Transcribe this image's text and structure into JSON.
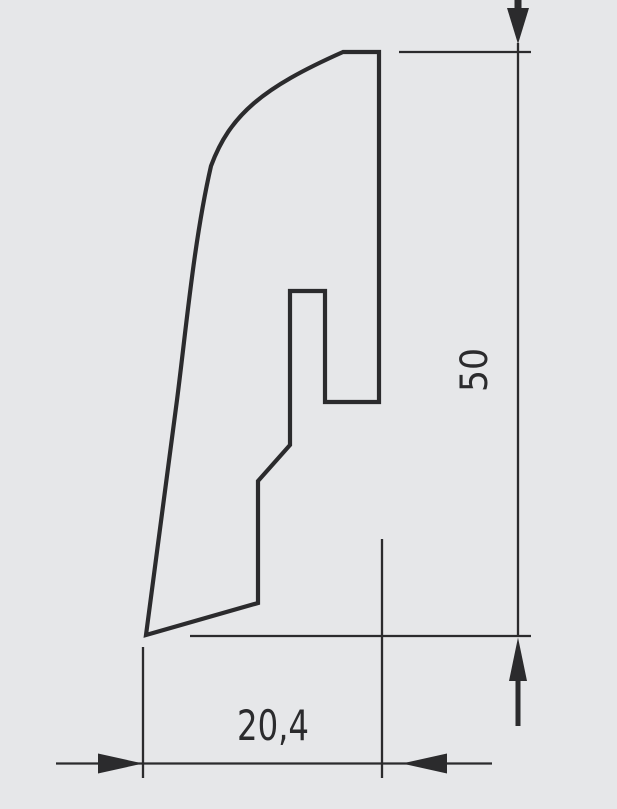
{
  "diagram": {
    "colors": {
      "background": "#e6e7e9",
      "line": "#2b2b2d"
    },
    "height_dimension": {
      "label": "50"
    },
    "width_dimension": {
      "label": "20,4"
    }
  }
}
